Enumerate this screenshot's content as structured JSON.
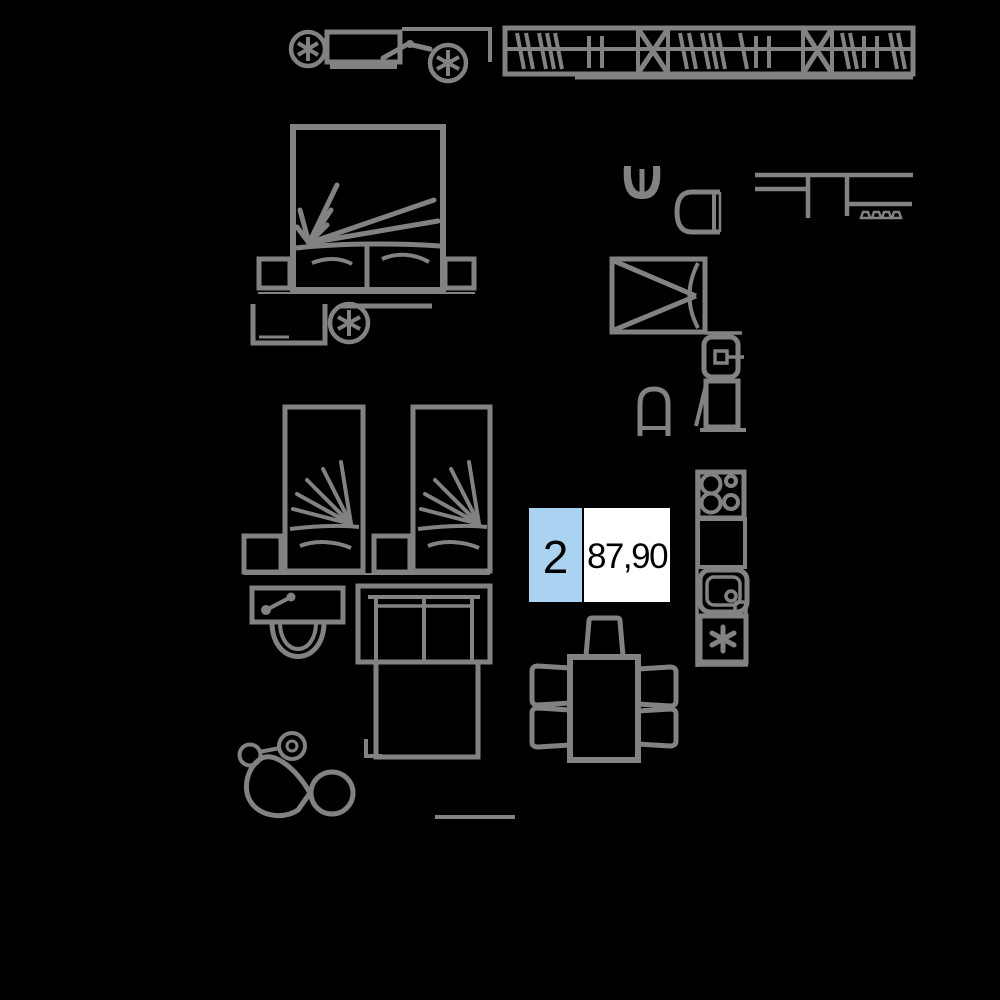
{
  "page": {
    "background_color": "#000000",
    "line_color": "#828282"
  },
  "unit_badge": {
    "number": "2",
    "area": "87,90",
    "number_bg_color": "#a9d3f1",
    "area_bg_color": "#ffffff",
    "text_color": "#000000",
    "border_color": "#000000"
  },
  "floor_plan": {
    "icons": [
      "pram-side-icon",
      "wardrobe-icon",
      "double-bed-icon",
      "nightstand-left-icon",
      "nightstand-right-icon",
      "desk-icon",
      "stool-icon",
      "single-bed-left-icon",
      "single-bed-right-icon",
      "bedside-cabinet-left-icon",
      "bedside-cabinet-right-icon",
      "toilet-icon",
      "sofa-bed-icon",
      "dining-table-icon",
      "dining-chair-icon",
      "washbasin-icon",
      "toilet-bowl-icon",
      "kitchen-counter-icon",
      "shower-cabin-icon",
      "washing-machine-icon",
      "water-heater-icon",
      "wall-toilet-icon",
      "stove-icon",
      "kitchen-cabinet-icon",
      "kitchen-sink-icon",
      "dishwasher-icon",
      "stroller-icon",
      "floor-line"
    ]
  }
}
